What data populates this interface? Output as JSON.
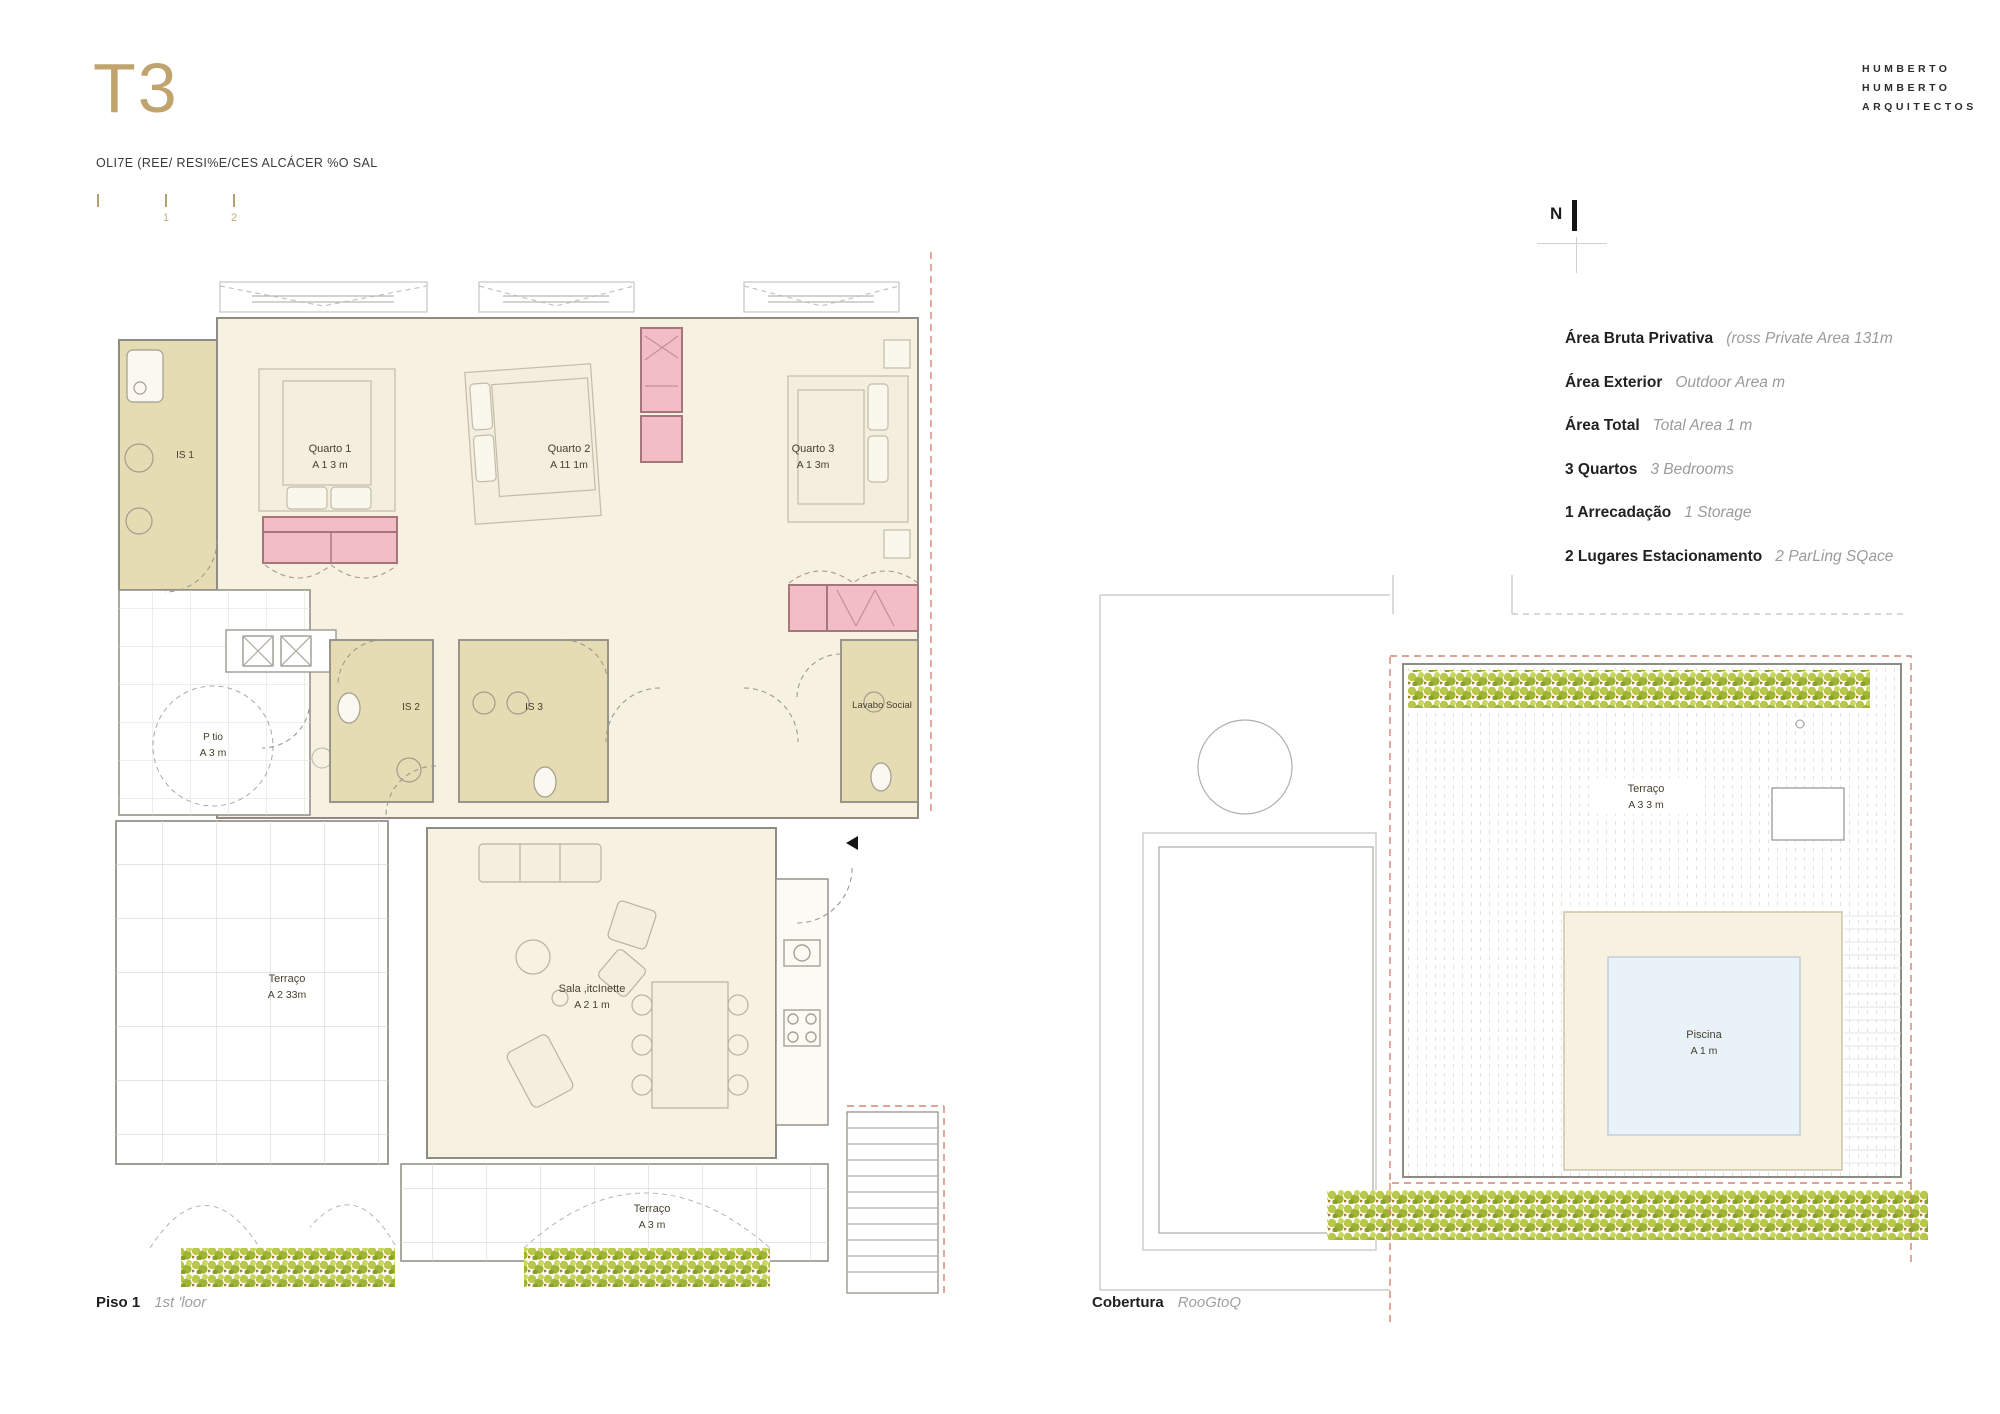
{
  "header": {
    "title": "T3",
    "subtitle": "OLI7E (REE/ RESI%E/CES  ALCÁCER %O SAL",
    "scale_labels": [
      "1",
      "2"
    ],
    "logo_lines": [
      "HUMBERTO",
      "HUMBERTO",
      "ARQUITECTOS"
    ]
  },
  "north": {
    "label": "N"
  },
  "info": {
    "rows": [
      {
        "label": "Área Bruta Privativa",
        "value": "(ross Private Area  131m"
      },
      {
        "label": "Área Exterior",
        "value": "Outdoor Area    m"
      },
      {
        "label": "Área Total",
        "value": "Total Area  1  m"
      },
      {
        "label": "3 Quartos",
        "value": "3 Bedrooms"
      },
      {
        "label": "1 Arrecadação",
        "value": "1 Storage"
      },
      {
        "label": "2 Lugares Estacionamento",
        "value": "2 ParLing SQace"
      }
    ]
  },
  "plans": {
    "floor1": {
      "caption": "Piso 1",
      "caption_sub": "1st 'loor",
      "rooms": {
        "is1": {
          "name": "IS 1"
        },
        "quarto1": {
          "name": "Quarto 1",
          "area": "A  1 3 m"
        },
        "quarto2": {
          "name": "Quarto 2",
          "area": "A  11 1m"
        },
        "quarto3": {
          "name": "Quarto 3",
          "area": "A  1  3m"
        },
        "is2": {
          "name": "IS 2"
        },
        "is3": {
          "name": "IS 3"
        },
        "lavabo": {
          "name": "Lavabo Social"
        },
        "patio": {
          "name": "P tio",
          "area": "A 3  m"
        },
        "terraco_left": {
          "name": "Terraço",
          "area": "A  2 33m"
        },
        "sala": {
          "name": "Sala  ,itcInette",
          "area": "A  2 1 m"
        },
        "terraco_bottom": {
          "name": "Terraço",
          "area": "A   3 m"
        }
      }
    },
    "cobertura": {
      "caption": "Cobertura",
      "caption_sub": "RooGtoQ",
      "rooms": {
        "terraco": {
          "name": "Terraço",
          "area": "A  3 3 m"
        },
        "piscina": {
          "name": "Piscina",
          "area": "A  1   m"
        }
      }
    }
  },
  "colors": {
    "accent_gold": "#bfa46e",
    "room_cream": "#f6f1e0",
    "bath_khaki": "#e6dcb4",
    "closet_pink": "#f3bdc6",
    "pool_blue": "#e9f2f8",
    "hedge_green": "#b5c64a",
    "boundary_red": "#cf8572"
  }
}
